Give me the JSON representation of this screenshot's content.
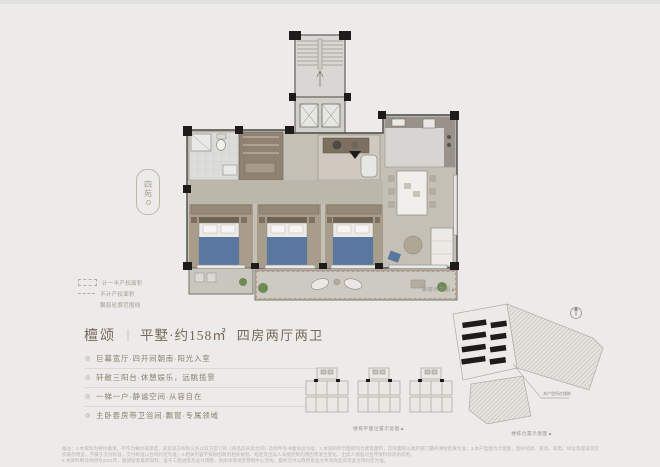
{
  "colors": {
    "background": "#ecebe9",
    "wall": "#2a2926",
    "floor_gray": "#c4c0b6",
    "floor_tan": "#a89c8b",
    "bed_blue": "#5a77a0",
    "balcony_dash_red": "#c4867c",
    "plant_green": "#6d8a55",
    "title_text": "#77685a",
    "body_text": "#8b8072"
  },
  "seal": {
    "char1": "四",
    "char2": "苑"
  },
  "legend": {
    "items": [
      {
        "label": "计一半产权面积"
      },
      {
        "label": "不计产权面积"
      },
      {
        "label": "飘窗轮廓范围线"
      }
    ]
  },
  "floorplan": {
    "balcony_note": "飘窗示意图▲"
  },
  "title": {
    "project": "檀颂",
    "divider": "｜",
    "spec": "平墅·约158㎡",
    "rooms": "四房两厅两卫"
  },
  "marker": "◎",
  "features": [
    "巨幕宽厅·四开间朝南·阳光入室",
    "轩敞三阳台·休憩娱乐，远眺揽景",
    "一梯一户·静谧空间·从容自在",
    "主卧套房带卫浴间·飘窗·专属领域"
  ],
  "key_plans": {
    "caption": "楼栋平面位置示意图▲"
  },
  "site_plan": {
    "caption": "楼栋位置示意图▲",
    "leader_label": "本户型所在楼栋",
    "north": "N"
  },
  "disclaimer": {
    "line1": "备注：1.本资料为要约邀请，不作为要约或承诺，买卖双方权利义务以双方签订的《商品房买卖合同》及附件等书面协议为准；2.本资料所示面积均为建筑面积，实际面积以政府部门最终测绘结果为准；3.本户型图为示意图，图中装修、家具、家电、绿化及摆设等仅作展示用途，不属于交付标准，交付标准以合同约定为准；4.相关内容不排除因政府相关规划、规定及出卖人未能控制的原因而发生变化，出卖人保留对宣传资料修改的权利。",
    "line2": "5.本资料制作时间为2021年，敬请留意最新资料；鉴于工程进度及设计调整，具体详情请至营销中心咨询，最终交付以政府批准文件及商品房买卖合同约定为准。"
  }
}
